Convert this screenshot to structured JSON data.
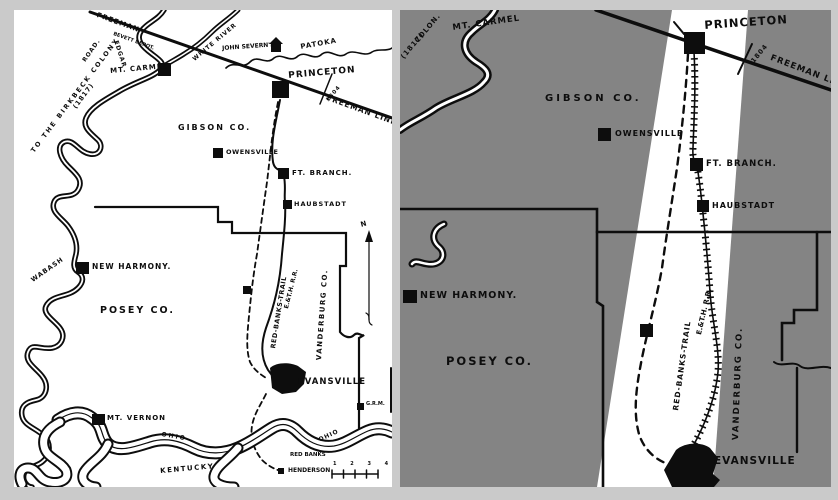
{
  "page": {
    "background": "#cacaca"
  },
  "left_map": {
    "description": "original printed map, black ink on white",
    "colors": {
      "background": "#ffffff",
      "ink": "#0d0d0d"
    },
    "labels": {
      "freeman": "FREEMAN",
      "freeman_depot": "BEVETT DEPOT.",
      "white_river": "WHITE RIVER",
      "john_severns": "JOHN SEVERN'S",
      "patoka": "PATOKA",
      "princeton": "PRINCETON",
      "survey_date": "1804",
      "freeman_line": "FREEMAN LINE.",
      "birkbeck_road": "TO THE BIRKBECK COLONY",
      "birkbeck_date": "(1817)",
      "road": "ROAD.",
      "edgar": "EDGAR",
      "mt_carmel": "MT. CARMEL",
      "gibson_co": "GIBSON CO.",
      "owensville": "OWENSVILLE",
      "ft_branch": "FT. BRANCH.",
      "haubstadt": "HAUBSTADT",
      "wabash_river": "WABASH",
      "new_harmony": "NEW HARMONY.",
      "posey_co": "POSEY CO.",
      "red_banks_trail": "RED-BANKS-TRAIL",
      "e_th_rr": "E.&T.H. R.R.",
      "vanderburg_co": "VANDERBURG CO.",
      "north": "N",
      "evansville": "EVANSVILLE",
      "grm": "G.R.M.",
      "mt_vernon": "MT. VERNON",
      "ohio_west": "OHIO",
      "ohio_east": "OHIO",
      "kentucky": "KENTUCKY",
      "red_banks": "RED BANKS",
      "henderson": "HENDERSON",
      "scale_numbers": "1 2 3 4"
    }
  },
  "right_map": {
    "description": "enlarged copy with gray overlay and white highlight strip along the Red Banks Trail corridor",
    "colors": {
      "background": "#848484",
      "highlight": "#ffffff",
      "ink": "#0d0d0d"
    },
    "labels": {
      "colony": "COLON.",
      "colony_date": "(1817)",
      "mt_carmel": "MT. CARMEL",
      "gibson_co": "GIBSON CO.",
      "owensville": "OWENSVILLE",
      "princeton": "PRINCETON",
      "survey_date": "1804",
      "freeman_line": "FREEMAN LINE.",
      "ft_branch": "FT. BRANCH.",
      "haubstadt": "HAUBSTADT",
      "new_harmony": "NEW HARMONY.",
      "posey_co": "POSEY CO.",
      "red_banks_trail": "RED-BANKS-TRAIL",
      "e_th_rr": "E.&T.H. R.R.",
      "vanderburg_co": "VANDERBURG CO.",
      "evansville": "EVANSVILLE"
    }
  }
}
